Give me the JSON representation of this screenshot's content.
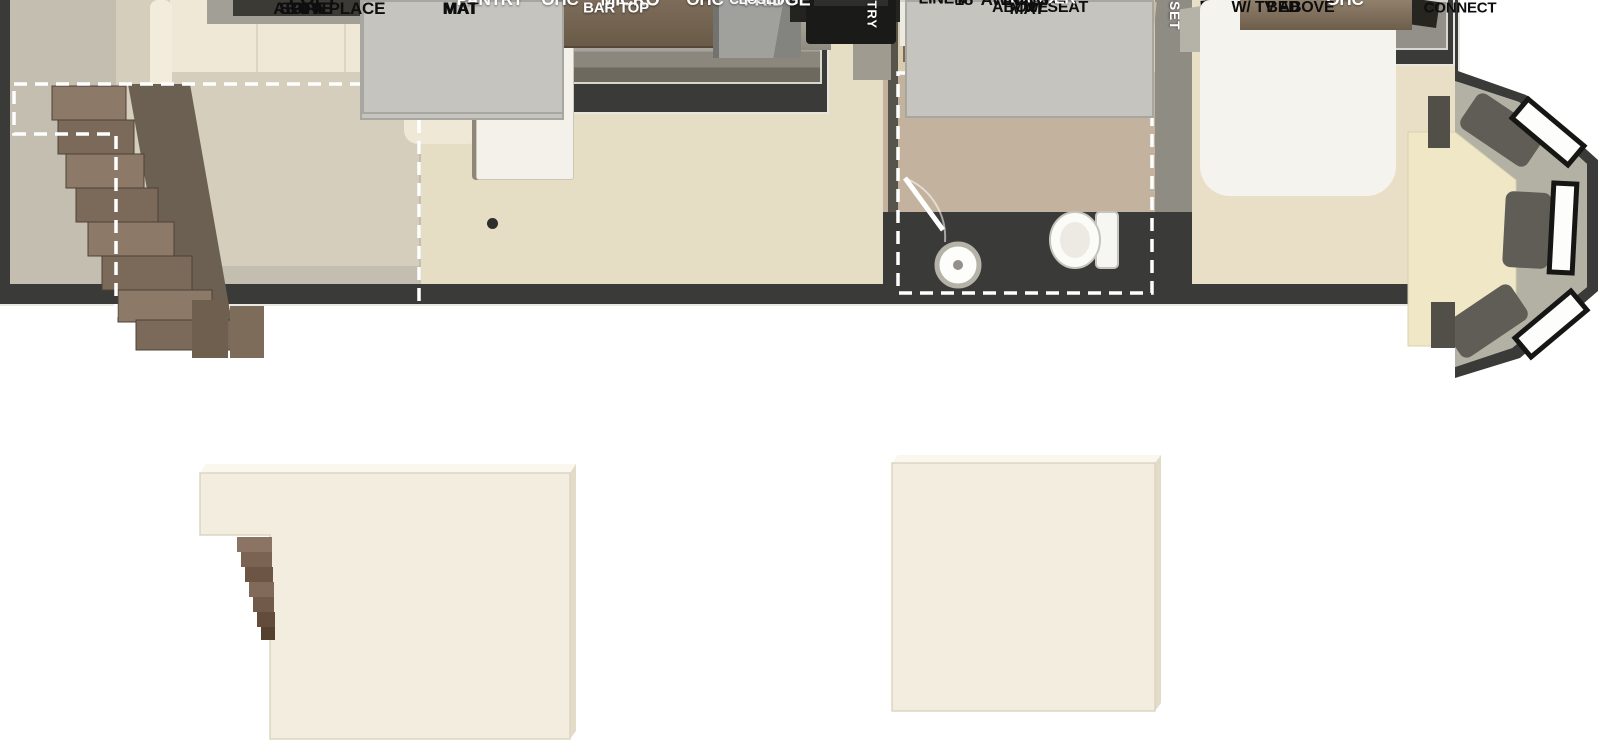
{
  "colors": {
    "wall": "#3a3a38",
    "kitchen_floor": "#e6ddc5",
    "living_floor": "#c3beb0",
    "bath_floor": "#c3b29d",
    "hall_floor": "#d8cbae",
    "bedroom_floor": "#e8dfc6",
    "cabinet_gray": "#96938b",
    "bar_brown": "#75644f",
    "loft_cream": "#f2eddf",
    "bunk_gray": "#c5c4bf",
    "bench_cream": "#efe7c5",
    "label_dark": "#0e0e0e",
    "label_light": "#ffffff"
  },
  "labels": {
    "kitchen_slide": [
      "PANTRY",
      "OHC",
      "MICRO",
      "OHC",
      "FRIDGE"
    ],
    "living": {
      "sectional_sofa": "SECTIONAL\nSOFA",
      "loft_above": "LOFT\nABOVE",
      "tv_fireplace": "TV &\nFIREPLACE"
    },
    "kitchen": {
      "flip_down_bar": "FLIP-DOWN\nBAR TOP",
      "closet": "CLOSET",
      "pantry": "PANTRY"
    },
    "bathroom": {
      "linen": "LINEN",
      "shower": "SHOWER\nW/ SEAT",
      "loft_above": "LOFT\nABOVE"
    },
    "hallway": {
      "ladder": "LADDER"
    },
    "bedroom": {
      "ohc": "OHC",
      "closet": "CLOSET",
      "king_bed": "KING\nBED",
      "dresser": "DRESSER\nW/ TV ABOVE"
    },
    "exterior": {
      "awning": "18’ AWNING",
      "lp_quick_connect": "LP QUICK\nCONNECT"
    },
    "lofts": {
      "bunk_mat": "BUNK\nMAT",
      "left_label": "LOFT",
      "right_label": "LOFT"
    }
  }
}
